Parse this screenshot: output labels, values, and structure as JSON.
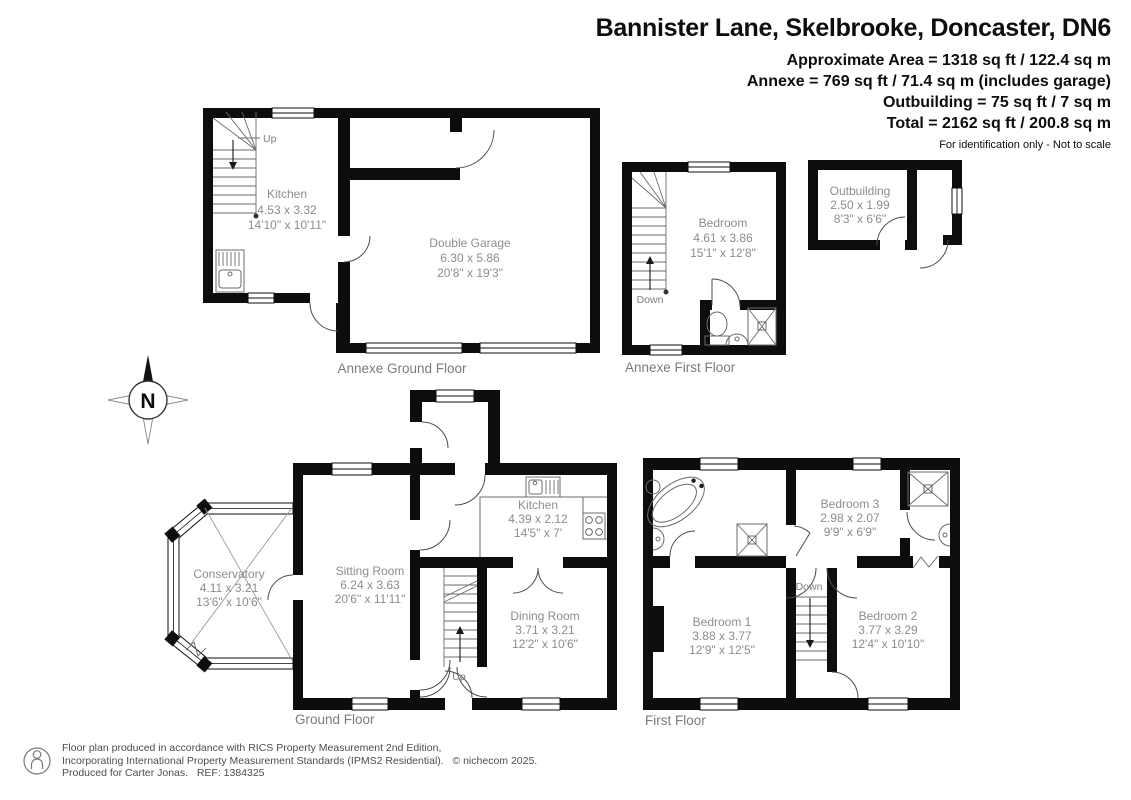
{
  "header": {
    "title": "Bannister Lane, Skelbrooke, Doncaster, DN6",
    "area_lines": [
      "Approximate Area = 1318 sq ft / 122.4 sq m",
      "Annexe = 769 sq ft / 71.4 sq m (includes garage)",
      "Outbuilding = 75 sq ft / 7 sq m",
      "Total = 2162 sq ft / 200.8 sq m"
    ],
    "disclaimer": "For identification only - Not to scale"
  },
  "plans": {
    "annexe_ground": {
      "label": "Annexe Ground Floor",
      "stair_label": "Up",
      "rooms": {
        "kitchen": {
          "name": "Kitchen",
          "metric": "4.53 x 3.32",
          "imperial": "14'10\" x 10'11\""
        },
        "garage": {
          "name": "Double Garage",
          "metric": "6.30 x 5.86",
          "imperial": "20'8\" x 19'3\""
        }
      }
    },
    "annexe_first": {
      "label": "Annexe First Floor",
      "stair_label": "Down",
      "rooms": {
        "bedroom": {
          "name": "Bedroom",
          "metric": "4.61 x 3.86",
          "imperial": "15'1\" x 12'8\""
        }
      }
    },
    "outbuilding": {
      "rooms": {
        "outbuilding": {
          "name": "Outbuilding",
          "metric": "2.50 x 1.99",
          "imperial": "8'3\" x 6'6\""
        }
      }
    },
    "ground": {
      "label": "Ground Floor",
      "stair_label": "Up",
      "rooms": {
        "conservatory": {
          "name": "Conservatory",
          "metric": "4.11 x 3.21",
          "imperial": "13'6\" x 10'6\""
        },
        "sitting": {
          "name": "Sitting Room",
          "metric": "6.24 x 3.63",
          "imperial": "20'6\" x 11'11\""
        },
        "kitchen": {
          "name": "Kitchen",
          "metric": "4.39 x 2.12",
          "imperial": "14'5\" x 7'"
        },
        "dining": {
          "name": "Dining Room",
          "metric": "3.71 x 3.21",
          "imperial": "12'2\" x 10'6\""
        }
      }
    },
    "first": {
      "label": "First Floor",
      "stair_label": "Down",
      "rooms": {
        "bed1": {
          "name": "Bedroom 1",
          "metric": "3.88 x 3.77",
          "imperial": "12'9\" x 12'5\""
        },
        "bed2": {
          "name": "Bedroom 2",
          "metric": "3.77 x 3.29",
          "imperial": "12'4\" x 10'10\""
        },
        "bed3": {
          "name": "Bedroom 3",
          "metric": "2.98 x 2.07",
          "imperial": "9'9\" x 6'9\""
        }
      }
    }
  },
  "compass": {
    "north": "N"
  },
  "footer": {
    "lines": [
      "Floor plan produced in accordance with RICS Property Measurement 2nd Edition,",
      "Incorporating International Property Measurement Standards (IPMS2 Residential).   © nichecom 2025.",
      "Produced for Carter Jonas.   REF: 1384325"
    ]
  },
  "colors": {
    "walls": "#0d0d0d",
    "room_text": "#8d8d8d",
    "floor_label_text": "#7c7c7c"
  }
}
